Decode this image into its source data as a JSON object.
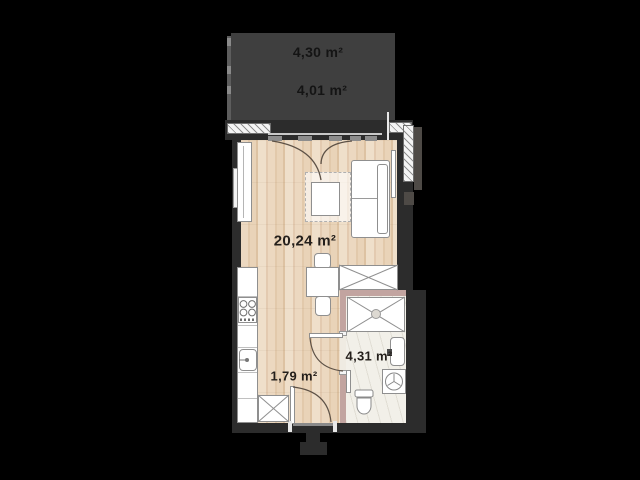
{
  "meta": {
    "type": "apartment-floor-plan"
  },
  "labels": {
    "balcony_upper": "4,30 m²",
    "balcony_lower": "4,01 m²",
    "living_room": "20,24 m²",
    "hallway": "1,79 m²",
    "bathroom": "4,31 m²"
  },
  "colors": {
    "background": "#000000",
    "wall": "#2c2c2c",
    "balcony_fill": "#3f3f3f",
    "wood_floor": "#e8d3ba",
    "bathroom_wall": "#c2a4a0",
    "bathroom_floor": "#f2f0e9",
    "furniture_fill": "#ffffff",
    "furniture_outline": "#8f8f8f",
    "label_text": "#241f1b"
  },
  "fixtures": [
    "balcony",
    "wardrobe",
    "sofa",
    "rug",
    "coffee-table",
    "dining-table",
    "chair",
    "kitchen-counter",
    "stove",
    "kitchen-sink",
    "shower",
    "washbasin",
    "washing-machine",
    "toilet",
    "towel-radiator",
    "radiator",
    "balcony-door",
    "bathroom-door",
    "entrance-door"
  ]
}
